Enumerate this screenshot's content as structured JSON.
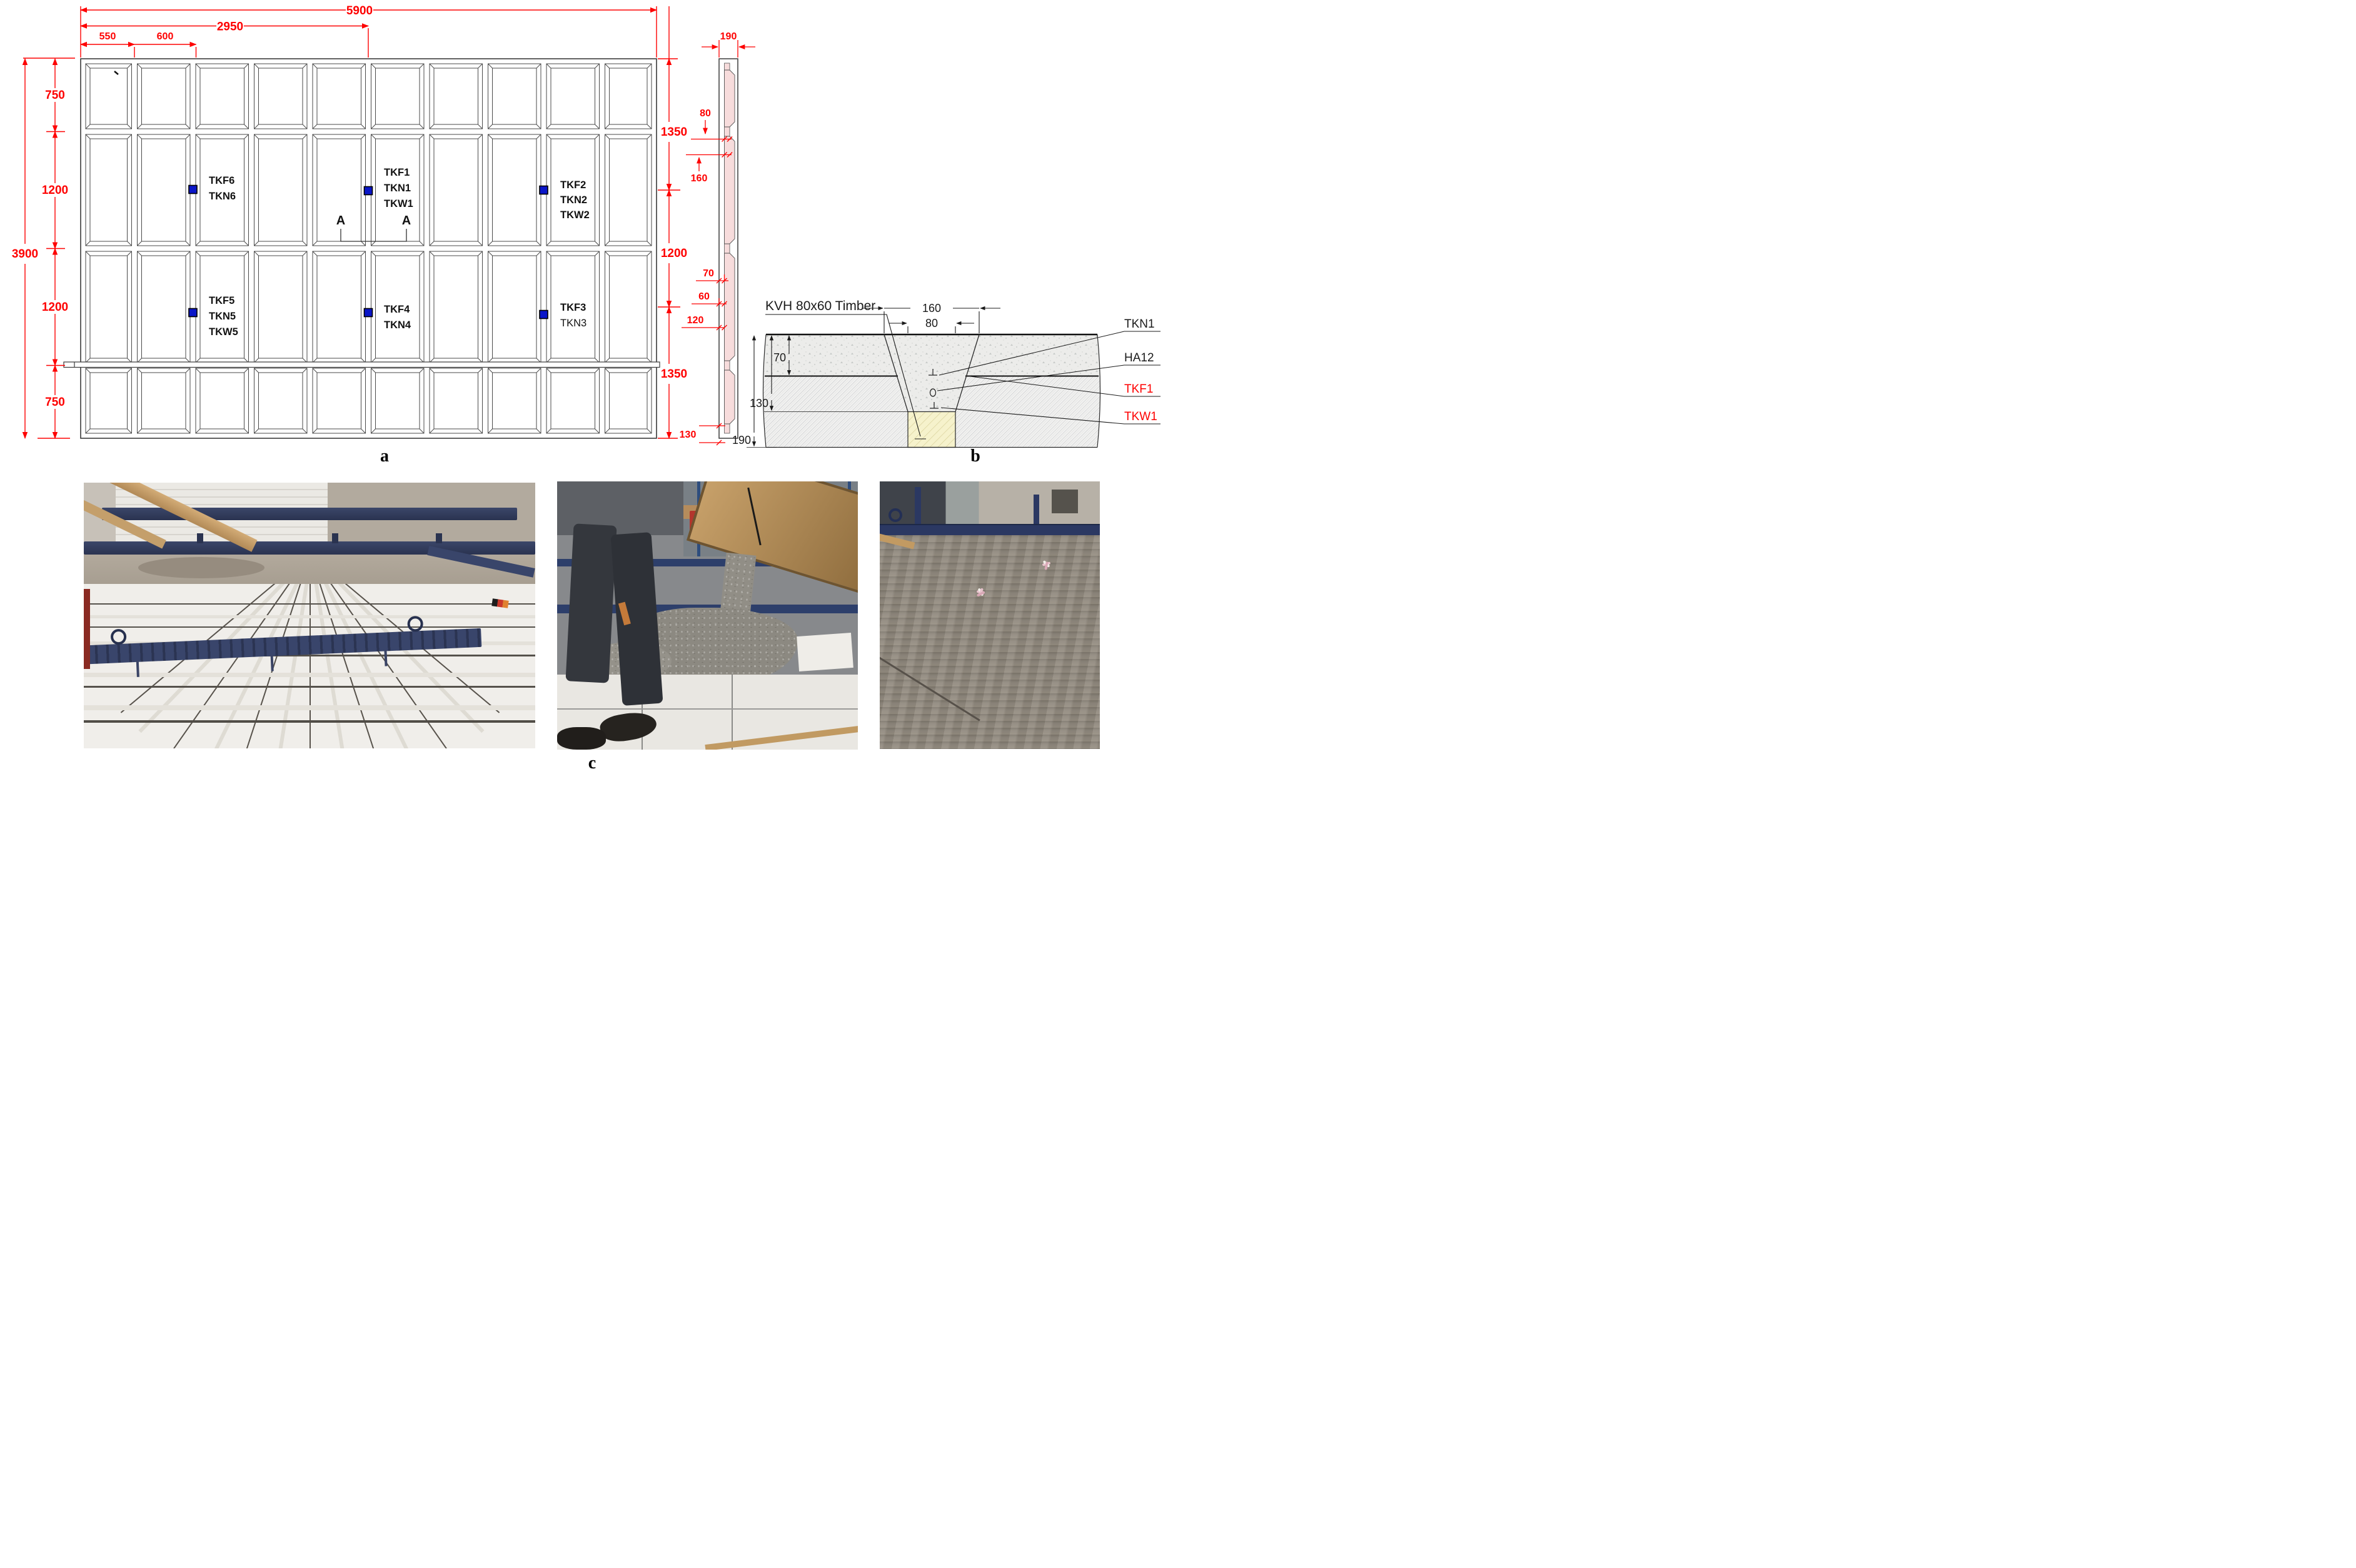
{
  "palette": {
    "dim_red": "#fe0000",
    "sensor_blue": "#0a16c8",
    "panel_pink": "#f7dcdc",
    "timber_yellow": "#f6f2cc",
    "concrete_gray": "#ececea",
    "line_dark": "#3a3a3a"
  },
  "figure_a": {
    "caption": "a",
    "top_dims": {
      "overall": "5900",
      "to_section": "2950",
      "edge": "550",
      "spacing": "600"
    },
    "left_dims": {
      "overall": "3900",
      "segments": [
        "750",
        "1200",
        "1200",
        "750"
      ]
    },
    "right_dims": {
      "segments": [
        "1350",
        "1200",
        "1350"
      ],
      "bottom": "130"
    },
    "side_dims": {
      "width": "190",
      "shell": "80",
      "notch": "160",
      "topping": "70",
      "core": "60",
      "rib": "120"
    },
    "section_mark": {
      "left": "A",
      "right": "A"
    },
    "sensors": [
      {
        "id": "s1",
        "lines": [
          "TKF1",
          "TKN1",
          "TKW1"
        ]
      },
      {
        "id": "s2",
        "lines": [
          "TKF2",
          "TKN2",
          "TKW2"
        ]
      },
      {
        "id": "s3",
        "lines": [
          "TKF3",
          "TKN3"
        ]
      },
      {
        "id": "s4",
        "lines": [
          "TKF4",
          "TKN4"
        ]
      },
      {
        "id": "s5",
        "lines": [
          "TKF5",
          "TKN5",
          "TKW5"
        ]
      },
      {
        "id": "s6",
        "lines": [
          "TKF6",
          "TKN6"
        ]
      }
    ]
  },
  "detail_b": {
    "caption": "b",
    "material_label": "KVH 80x60 Timber",
    "callouts": [
      {
        "text": "TKN1",
        "color": "#1a1a1a"
      },
      {
        "text": "HA12",
        "color": "#1a1a1a"
      },
      {
        "text": "TKF1",
        "color": "#fe0000"
      },
      {
        "text": "TKW1",
        "color": "#fe0000"
      }
    ],
    "dims": {
      "notch_top": "160",
      "timber_width": "80",
      "topping": "70",
      "to_timber": "130",
      "total": "190"
    }
  },
  "photos": {
    "caption": "c"
  }
}
